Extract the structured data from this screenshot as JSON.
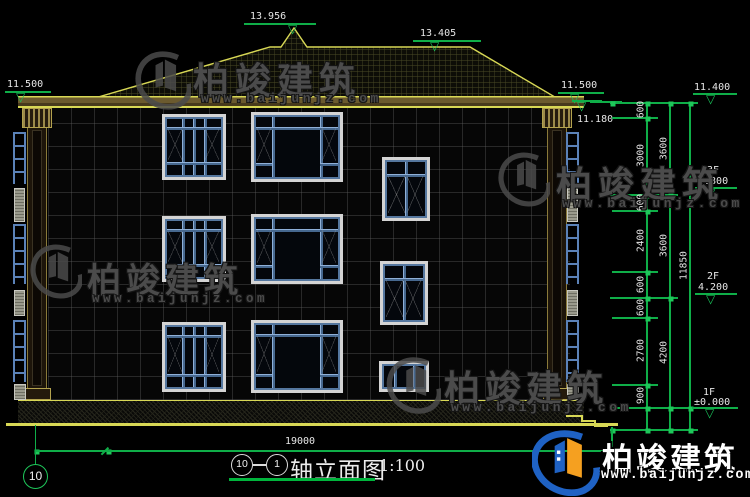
{
  "drawing": {
    "levels": {
      "peak": "13.956",
      "ridge": "13.405",
      "eave_left": "11.500",
      "eave_right": "11.500",
      "eave_soffit": "11.180",
      "roof_right": "11.400",
      "f3_label": "3F",
      "f3_value": "7.800",
      "f2_label": "2F",
      "f2_value": "4.200",
      "f1_label": "1F",
      "f1_value": "±0.000"
    },
    "dims": {
      "c1": [
        "600",
        "3000",
        "600",
        "2400",
        "600",
        "600",
        "2700",
        "900"
      ],
      "c2": [
        "3600",
        "3600",
        "4200"
      ],
      "total": "11850",
      "width": "19000"
    },
    "axis": {
      "left_bubble": "10",
      "title_start": "10",
      "title_end": "1"
    },
    "title": {
      "name": "轴立面图",
      "scale": "1:100"
    }
  },
  "watermark": {
    "brand": "柏竣建筑",
    "url": "www.baijunjz.com"
  },
  "icons": {
    "level_triangle": "▽"
  },
  "colors": {
    "dim_green": "#0fae48",
    "outline_yellow": "#d8d855",
    "window_blue": "#5b82b8",
    "logo_blue": "#1f62c4",
    "logo_orange": "#f5a020"
  }
}
